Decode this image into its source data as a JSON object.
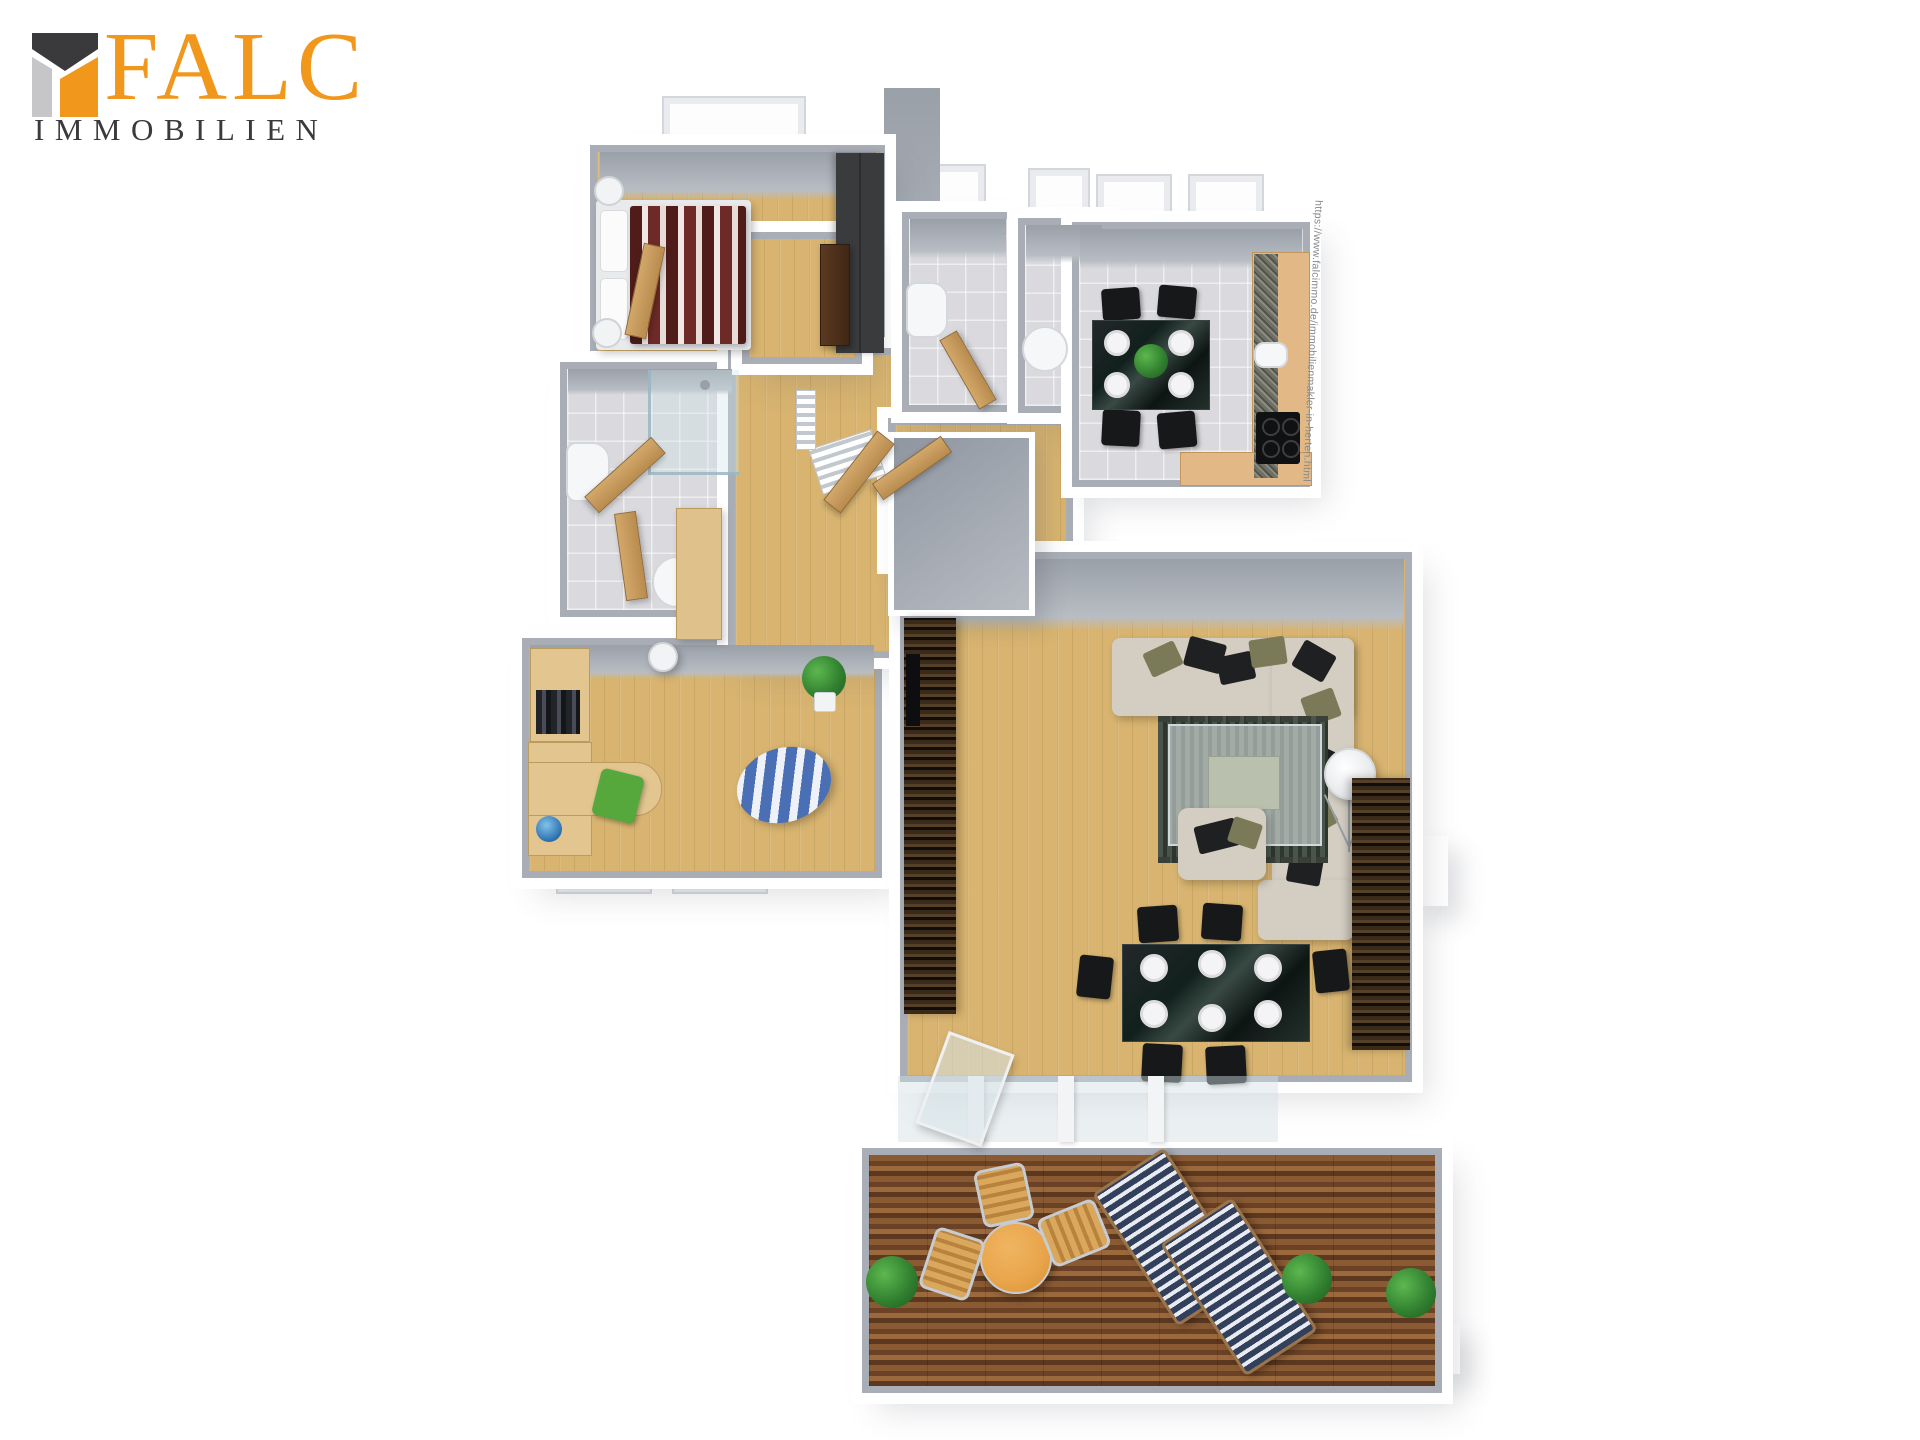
{
  "brand": {
    "name": "FALC",
    "subtitle": "IMMOBILIEN",
    "colors": {
      "orange": "#F0971C",
      "dark": "#3A393B",
      "light_gray": "#C6C6C8"
    }
  },
  "watermark": {
    "url_text": "https://www.falcimmo.de/immobilienmakler-in-herten.html"
  },
  "floorplan": {
    "view": "3d-top-down-apartment-render",
    "palette": {
      "wood_floor": "#D8B470",
      "tile_floor": "#DADADE",
      "deck_brown": "#7E4E2C",
      "wall_face": "#A9AEB6",
      "wall_top": "#FFFFFF",
      "sofa_beige": "#D3CDC2",
      "furniture_black": "#17181A",
      "duvet_red": "#58201E",
      "desk_chair_green": "#57A83C",
      "beanbag_blue": "#4A6FB5",
      "terrace_table_orange": "#E8A44A",
      "lounger_navy": "#32405C",
      "zebra_wood_dark": "#2A1D10",
      "kitchen_counter": "#E2B986",
      "granite": "#6E7066"
    },
    "rooms": [
      {
        "id": "bedroom",
        "furniture": [
          "double-bed",
          "striped-duvet",
          "bedside-lamps",
          "wardrobe",
          "window"
        ]
      },
      {
        "id": "bathroom",
        "furniture": [
          "shower",
          "toilet",
          "bidet",
          "wood-door"
        ]
      },
      {
        "id": "office",
        "furniture": [
          "bookshelf",
          "corner-desk",
          "green-chair",
          "beanbag",
          "plant",
          "vase",
          "windows"
        ]
      },
      {
        "id": "hallway",
        "furniture": [
          "radiators",
          "built-in-cabinet",
          "wood-doors",
          "apartment-door",
          "utility-shaft"
        ]
      },
      {
        "id": "guest-wc",
        "furniture": [
          "toilet",
          "door",
          "window"
        ]
      },
      {
        "id": "shower-room",
        "furniture": [
          "round-basin",
          "window"
        ]
      },
      {
        "id": "kitchen",
        "furniture": [
          "dining-table-4",
          "black-chairs",
          "plates",
          "plant",
          "counter",
          "sink",
          "cooktop",
          "windows"
        ]
      },
      {
        "id": "living-room",
        "furniture": [
          "corner-sofa",
          "cushions",
          "glass-coffee-table",
          "rug",
          "armchair",
          "tripod-floor-lamp",
          "tv-wall-unit",
          "sideboard",
          "dining-table-6",
          "black-chairs",
          "plates",
          "glass-front",
          "glass-entrance-door"
        ]
      },
      {
        "id": "terrace",
        "furniture": [
          "wood-deck",
          "round-orange-table",
          "bistro-chairs",
          "striped-sun-loungers",
          "plants"
        ]
      }
    ]
  }
}
